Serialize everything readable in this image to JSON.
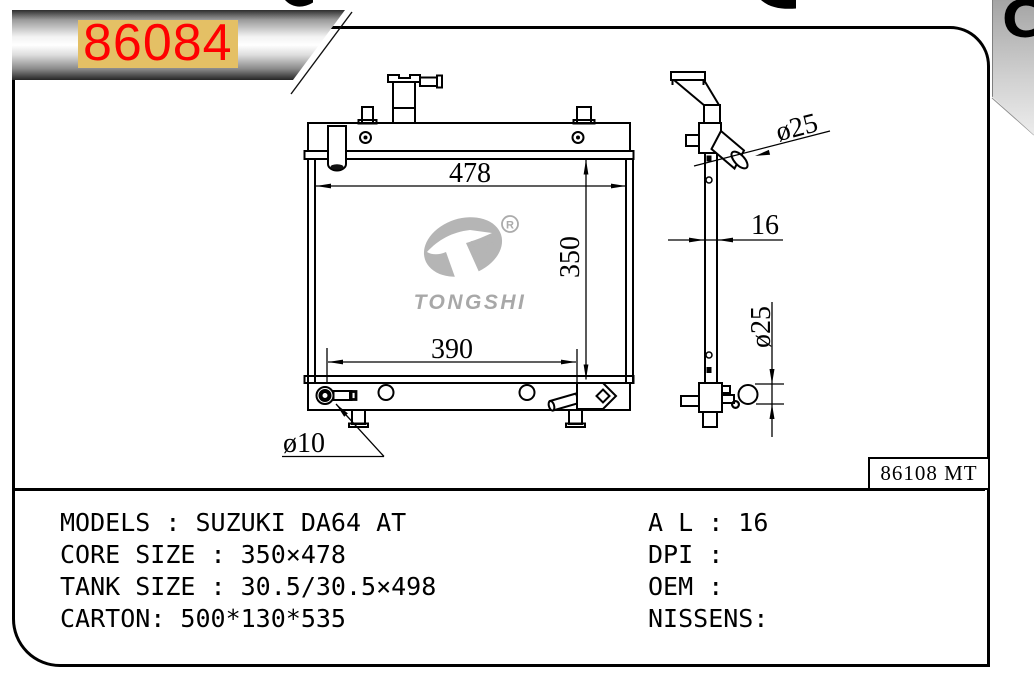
{
  "banner": {
    "part_number": "86084"
  },
  "corner_ribbon": {
    "glyph": "C"
  },
  "watermark": {
    "brand": "TONGSHI",
    "registered": "R"
  },
  "drawing": {
    "ref_code": "86108 MT",
    "front_view": {
      "width_dim": "478",
      "height_dim": "350",
      "lower_width_dim": "390",
      "drain_dim": "ø10"
    },
    "side_view": {
      "inlet_dim": "ø25",
      "thickness_dim": "16",
      "outlet_dim": "ø25"
    }
  },
  "specs": {
    "left": [
      "MODELS : SUZUKI DA64 AT",
      "CORE SIZE : 350×478",
      "TANK SIZE : 30.5/30.5×498",
      "CARTON: 500*130*535"
    ],
    "right": [
      "A L : 16",
      "DPI :",
      "OEM :",
      "NISSENS:"
    ]
  }
}
